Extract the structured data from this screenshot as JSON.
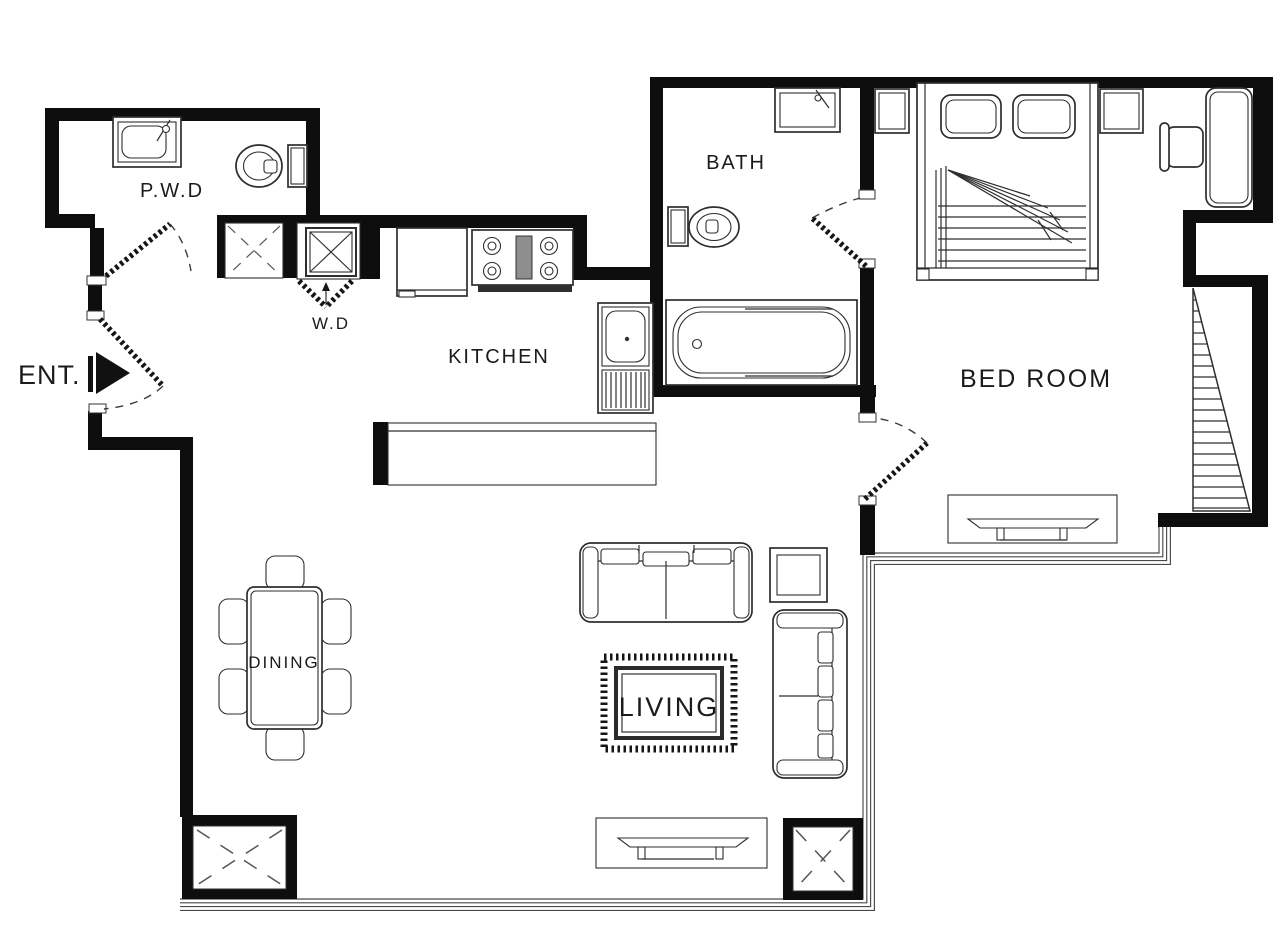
{
  "labels": {
    "pwd": "P.W.D",
    "wd": "W.D",
    "kitchen": "KITCHEN",
    "bath": "BATH",
    "bedroom": "BED ROOM",
    "dining": "DINING",
    "living": "LIVING",
    "entrance": "ENT."
  },
  "colors": {
    "wall": "#0e0e0e",
    "line": "#2e2e2e",
    "detail": "#4f4f4f",
    "background": "#ffffff",
    "text": "#1b1b1b"
  },
  "fixtures": [
    "vanity-sink",
    "toilet",
    "washer",
    "dryer",
    "refrigerator",
    "stove",
    "kitchen-sink",
    "bathtub",
    "double-bed",
    "pillow",
    "nightstand",
    "desk",
    "armchair",
    "dining-table",
    "dining-chair",
    "sofa",
    "side-table",
    "area-rug",
    "tv-console",
    "structural-column",
    "door-swing",
    "entry-arrow",
    "louver-hatch",
    "window-wall"
  ]
}
